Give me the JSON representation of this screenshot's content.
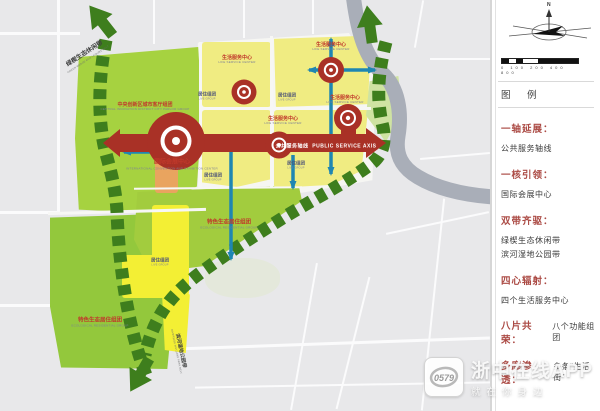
{
  "map": {
    "axis": {
      "zh": "公共服务轴线",
      "en": "PUBLIC SERVICE AXIS"
    },
    "labels": {
      "life_center": {
        "zh": "生活服务中心",
        "en": "LIFE SERVICE CENTER"
      },
      "live_group": {
        "zh": "居住组团",
        "en": "LIVE GROUP"
      },
      "eco_group": {
        "zh": "特色生态居住组团",
        "en": "ECOLOGICAL RESIDENTIAL GROUP"
      },
      "central_group": {
        "zh": "中央创新区城市客厅组团",
        "en": "CENTRAL INNOVATION DISTRICT CITY PARLOR GROUP"
      },
      "convention": {
        "zh": "国际会展中心",
        "en": "INTERNATIONAL CONVENTION AND EXHIBITION CENTER"
      },
      "belt_green": {
        "zh": "绿楔生态休闲带",
        "en": "GREEN WEDGE ECO LEISURE BELT"
      },
      "belt_river": {
        "zh": "滨河湿地公园带",
        "en": "RIVERSIDE WETLAND PARK BELT"
      }
    }
  },
  "panel": {
    "legend_title": "图 例",
    "compass_n": "N",
    "scale_ticks": "0 100 200 400  800"
  },
  "legend": {
    "items": [
      {
        "term": "一轴延展：",
        "desc": [
          "公共服务轴线"
        ]
      },
      {
        "term": "一核引领：",
        "desc": [
          "国际会展中心"
        ]
      },
      {
        "term": "双带齐驱：",
        "desc": [
          "绿楔生态休闲带",
          "滨河湿地公园带"
        ]
      },
      {
        "term": "四心辐射：",
        "desc": [
          "四个生活服务中心"
        ]
      },
      {
        "term": "八片共荣：",
        "desc": [
          "八个功能组团"
        ]
      },
      {
        "term": "多廊渗透：",
        "desc": [
          "多条“生活街”"
        ]
      }
    ]
  },
  "watermark": {
    "title": "浙中在线APP",
    "subtitle": "就在你身边",
    "badge": "0579"
  },
  "colors": {
    "axis_red": "#a93126",
    "belt_green": "#3e7e1d",
    "zone_yellow": "#f0ec82",
    "zone_bright_yellow": "#f3ef34",
    "zone_green": "#a6d240",
    "river_gray": "#a9aeb8",
    "legend_red": "#ab4a44",
    "arrow_blue": "#1f86b2"
  }
}
